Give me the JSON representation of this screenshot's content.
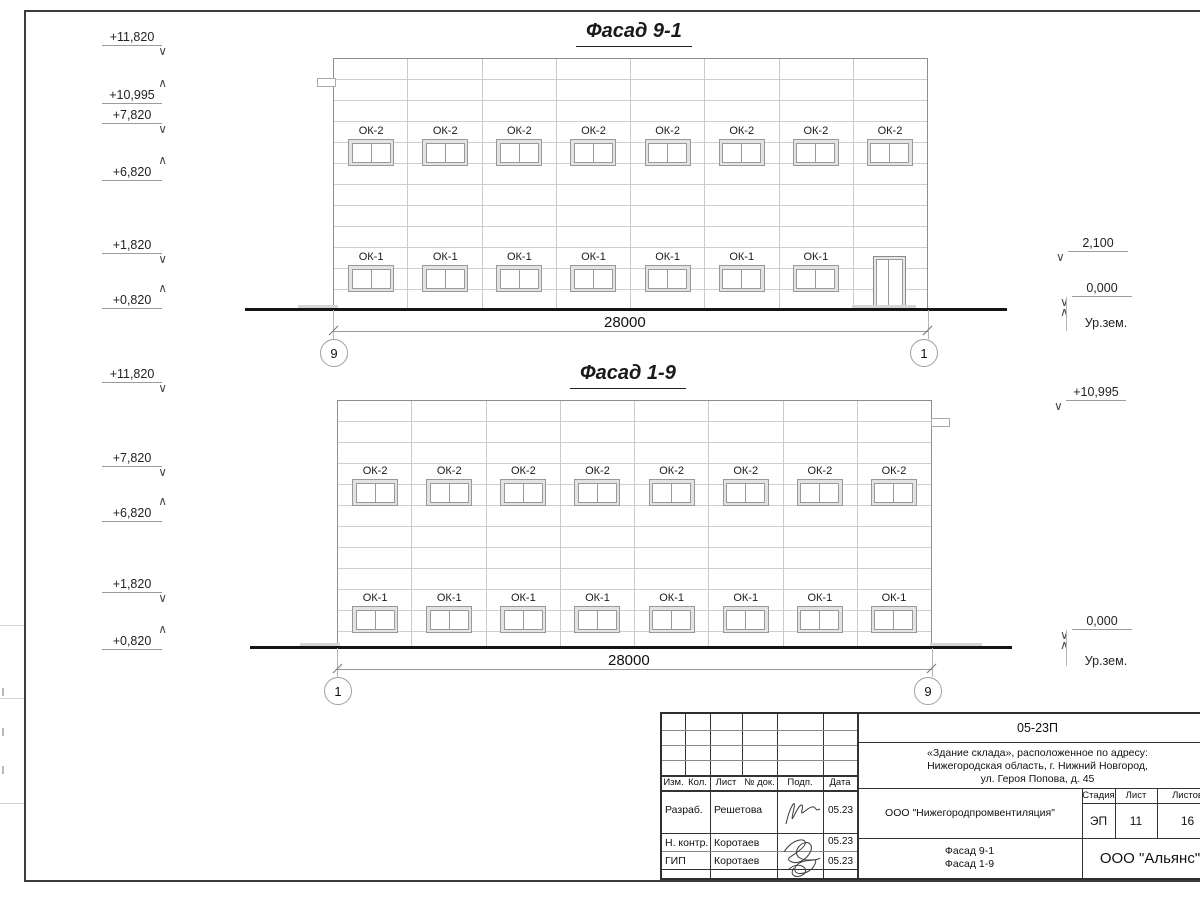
{
  "icons": {
    "level_down": "∨",
    "level_up": "∧"
  },
  "sheet": {
    "facades": [
      {
        "title": "Фасад 9-1",
        "dimension": "28000",
        "axis_left": "9",
        "axis_right": "1",
        "top_row": {
          "label": "ОК-2",
          "count": 8
        },
        "bottom_row": {
          "label": "ОК-1",
          "count": 7,
          "door": true
        },
        "marks_left": [
          {
            "label": "+11,820"
          },
          {
            "label": "+10,995"
          },
          {
            "label": "+7,820"
          },
          {
            "label": "+6,820"
          },
          {
            "label": "+1,820"
          },
          {
            "label": "+0,820"
          }
        ],
        "marks_right": {
          "upper": "2,100",
          "zero": "0,000",
          "ground": "Ур.зем."
        }
      },
      {
        "title": "Фасад 1-9",
        "dimension": "28000",
        "axis_left": "1",
        "axis_right": "9",
        "top_row": {
          "label": "ОК-2",
          "count": 8
        },
        "bottom_row": {
          "label": "ОК-1",
          "count": 8,
          "door": false
        },
        "marks_left": [
          {
            "label": "+11,820"
          },
          {
            "label": "+7,820"
          },
          {
            "label": "+6,820"
          },
          {
            "label": "+1,820"
          },
          {
            "label": "+0,820"
          }
        ],
        "marks_right": {
          "upper": "+10,995",
          "zero": "0,000",
          "ground": "Ур.зем."
        }
      }
    ],
    "titleblock": {
      "doc_number": "05-23П",
      "project_desc_lines": [
        "«Здание склада», расположенное по адресу:",
        "Нижегородская область, г. Нижний Новгород,",
        "ул. Героя Попова, д. 45"
      ],
      "org": "ООО \"Нижегородпромвентиляция\"",
      "sheet_title_line1": "Фасад 9-1",
      "sheet_title_line2": "Фасад 1-9",
      "company": "ООО \"Альянс\"",
      "stage_label": "Стадия",
      "sheet_label": "Лист",
      "sheets_label": "Листов",
      "stage": "ЭП",
      "sheet_no": "11",
      "sheets_total": "16",
      "header_cols": [
        "Изм.",
        "Кол.",
        "Лист",
        "№ док.",
        "Подп.",
        "Дата"
      ],
      "rows": [
        {
          "role": "Разраб.",
          "name": "Решетова",
          "date": "05.23"
        },
        {
          "role": "Н. контр.",
          "name": "Коротаев",
          "date": "05.23"
        },
        {
          "role": "ГИП",
          "name": "Коротаев",
          "date": "05.23"
        }
      ]
    }
  }
}
